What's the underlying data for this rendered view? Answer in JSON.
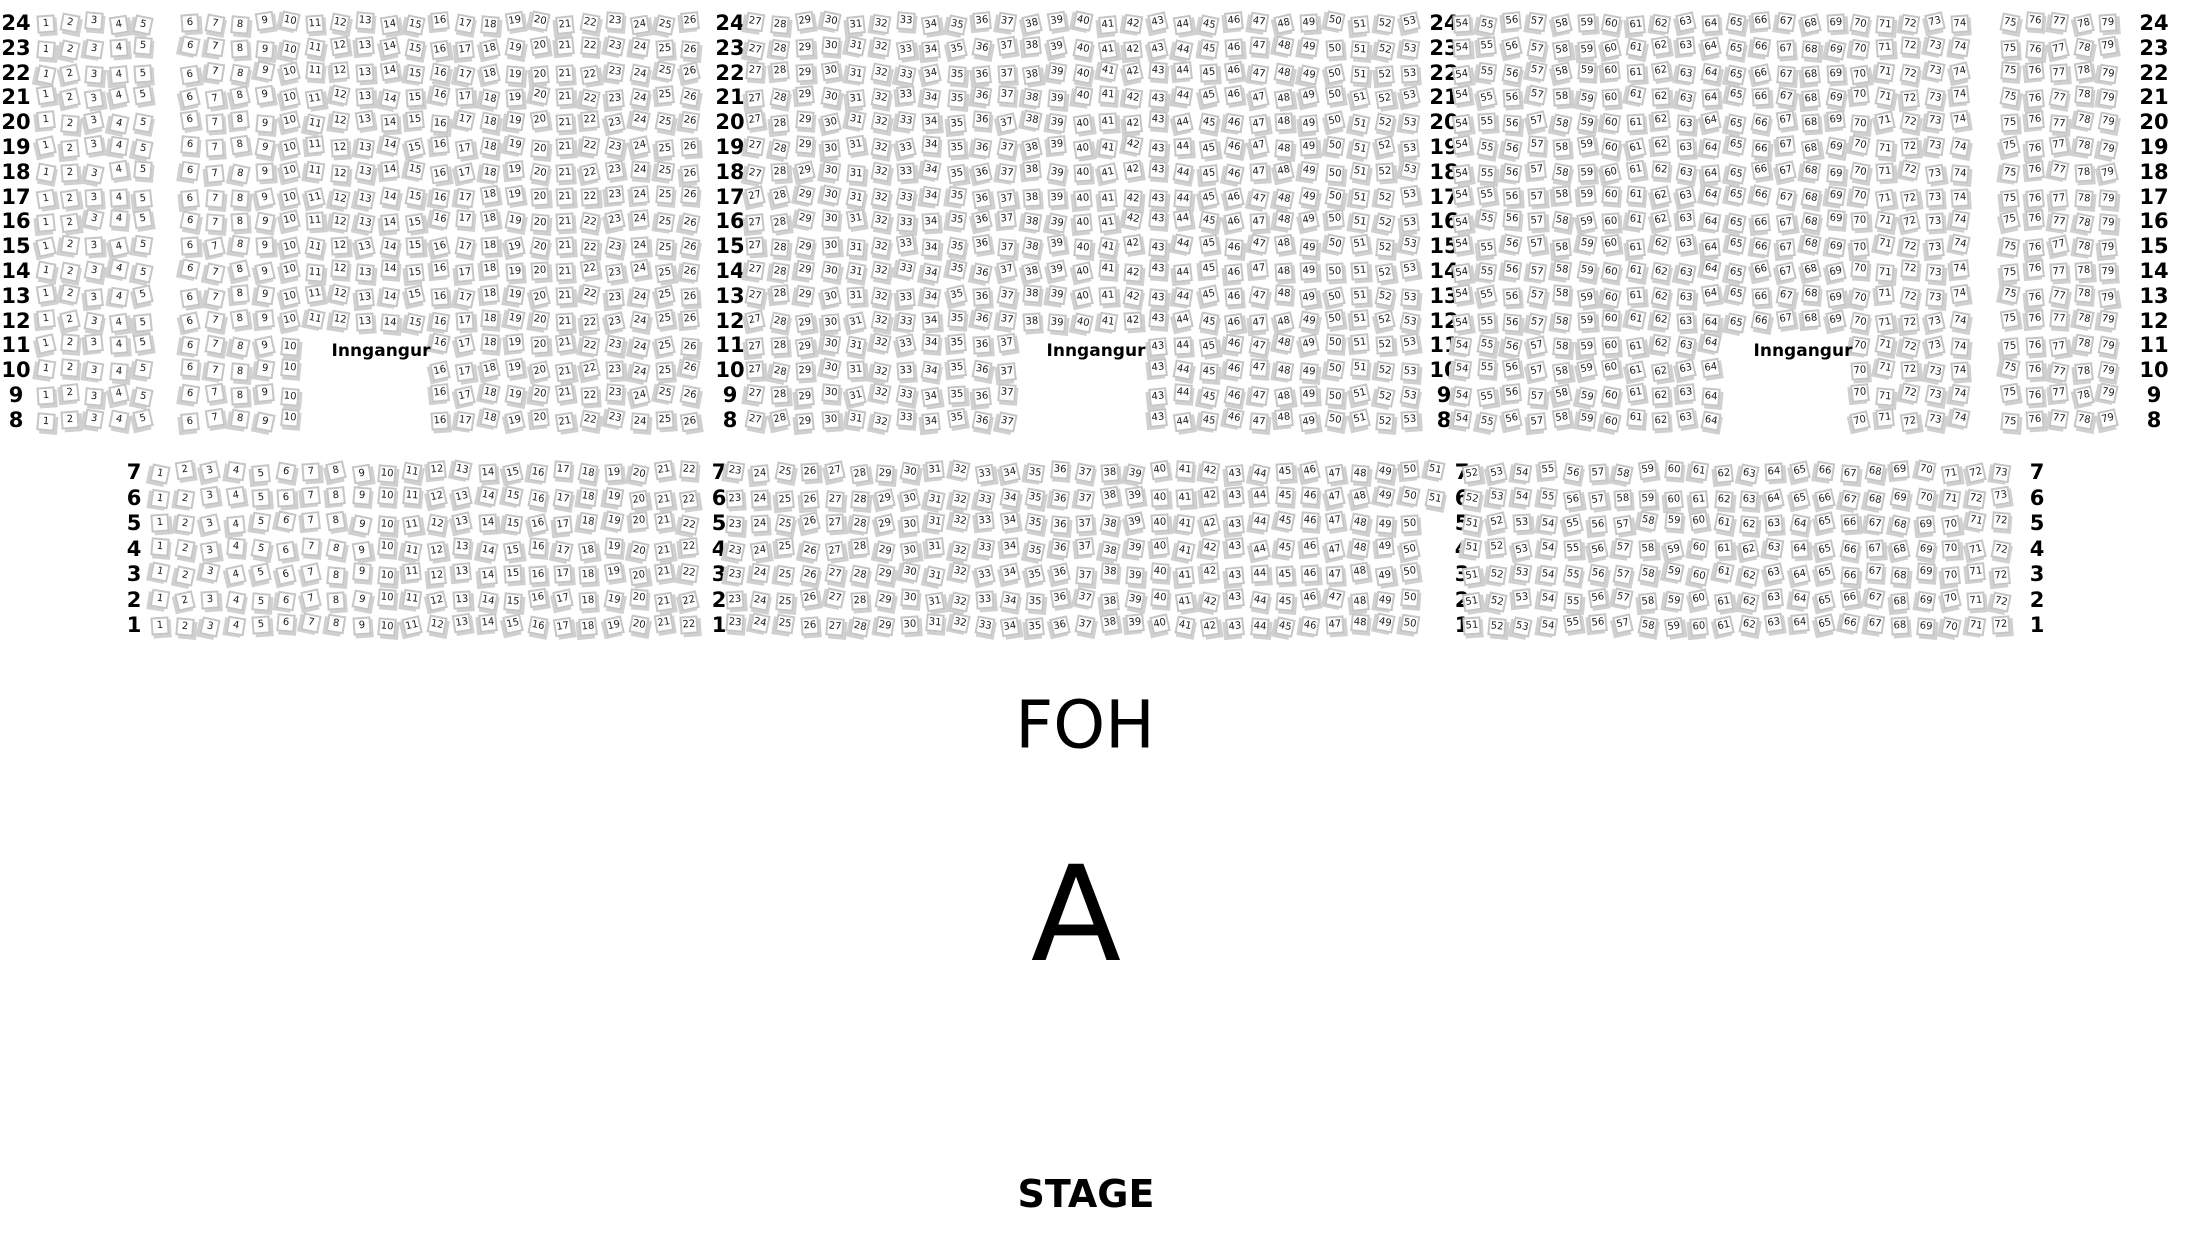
{
  "labels": {
    "foh": "FOH",
    "section": "A",
    "stage": "STAGE",
    "entrance": "Inngangur"
  },
  "colors": {
    "background": "#ffffff",
    "seat_fill": "#ffffff",
    "seat_border": "#c5c5c5",
    "seat_shadow": "#d0d0d0",
    "text": "#000000"
  },
  "seat_map": {
    "upper_section": {
      "row_numbers": [
        24,
        23,
        22,
        21,
        20,
        19,
        18,
        17,
        16,
        15,
        14,
        13,
        12,
        11,
        10,
        9,
        8
      ],
      "gap_rows": [
        11,
        10,
        9,
        8
      ],
      "geometry": {
        "y_start": 23,
        "row_pitch": 24.8
      },
      "row_label_columns_x": [
        16,
        730,
        1444,
        2154
      ],
      "blocks": [
        {
          "seat_from": 1,
          "seat_to": 5,
          "x_start": 46,
          "seat_pitch": 24.2
        },
        {
          "seat_from": 6,
          "seat_to": 26,
          "x_start": 190,
          "seat_pitch": 25.0,
          "gap_seat_from": 11,
          "gap_seat_to": 15
        },
        {
          "seat_from": 27,
          "seat_to": 53,
          "x_start": 755,
          "seat_pitch": 25.2,
          "gap_seat_from": 38,
          "gap_seat_to": 42
        },
        {
          "seat_from": 54,
          "seat_to": 74,
          "x_start": 1462,
          "seat_pitch": 24.9,
          "gap_seat_from": 65,
          "gap_seat_to": 69
        },
        {
          "seat_from": 75,
          "seat_to": 79,
          "x_start": 2010,
          "seat_pitch": 24.5
        }
      ],
      "entrance_labels": [
        {
          "x": 381,
          "y": 351
        },
        {
          "x": 1096,
          "y": 351
        },
        {
          "x": 1803,
          "y": 351
        }
      ]
    },
    "lower_section": {
      "row_numbers": [
        7,
        6,
        5,
        4,
        3,
        2,
        1
      ],
      "geometry": {
        "y_start": 472,
        "row_pitch": 25.5
      },
      "row_label_columns_x": [
        134,
        719,
        1462,
        2037
      ],
      "blocks": [
        {
          "x_start": 160,
          "seat_pitch": 25.2,
          "numbering": [
            {
              "rows": [
                7,
                6,
                5,
                4,
                3,
                2,
                1
              ],
              "seat_from": 1,
              "seat_to": 22
            }
          ]
        },
        {
          "x_start": 735,
          "seat_pitch": 25.0,
          "numbering": [
            {
              "rows": [
                7,
                6
              ],
              "seat_from": 23,
              "seat_to": 51
            },
            {
              "rows": [
                5,
                4,
                3,
                2,
                1
              ],
              "seat_from": 23,
              "seat_to": 50
            }
          ]
        },
        {
          "x_start": 1472,
          "seat_pitch": 25.2,
          "numbering": [
            {
              "rows": [
                7,
                6
              ],
              "seat_from": 52,
              "seat_to": 73
            },
            {
              "rows": [
                5,
                4,
                3,
                2,
                1
              ],
              "seat_from": 51,
              "seat_to": 72
            }
          ]
        }
      ]
    }
  }
}
